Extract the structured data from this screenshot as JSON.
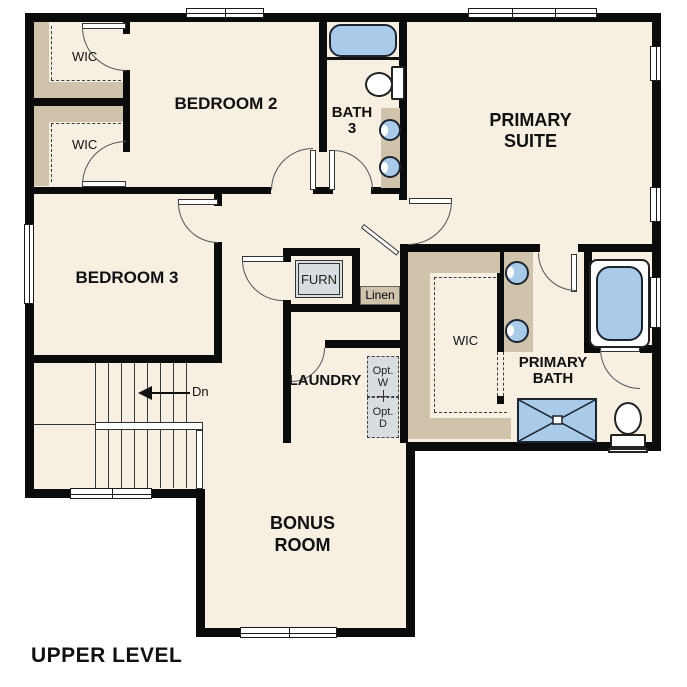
{
  "title": "UPPER LEVEL",
  "colors": {
    "floor": "#f6efe2",
    "wall": "#0b0b0b",
    "shelf": "#cfc3ac",
    "dash": "#3c3c3c",
    "fixture_blue": "#a9cbe9",
    "fixture_border": "#1c2430",
    "fixture_grey": "#d9dde1",
    "page_bg": "#ffffff"
  },
  "labels": {
    "bedroom2": "BEDROOM 2",
    "bedroom3": "BEDROOM 3",
    "bath3_line1": "BATH",
    "bath3_line2": "3",
    "primary_suite_line1": "PRIMARY",
    "primary_suite_line2": "SUITE",
    "primary_bath_line1": "PRIMARY",
    "primary_bath_line2": "BATH",
    "wic_bedroom2": "WIC",
    "wic_bedroom3": "WIC",
    "wic_primary": "WIC",
    "furn": "FURN",
    "linen": "Linen",
    "laundry": "LAUNDRY",
    "opt_washer_line1": "Opt.",
    "opt_washer_line2": "W",
    "opt_dryer_line1": "Opt.",
    "opt_dryer_line2": "D",
    "bonus_line1": "BONUS",
    "bonus_line2": "ROOM",
    "stairs_direction": "Dn",
    "floor_title": "UPPER LEVEL"
  }
}
